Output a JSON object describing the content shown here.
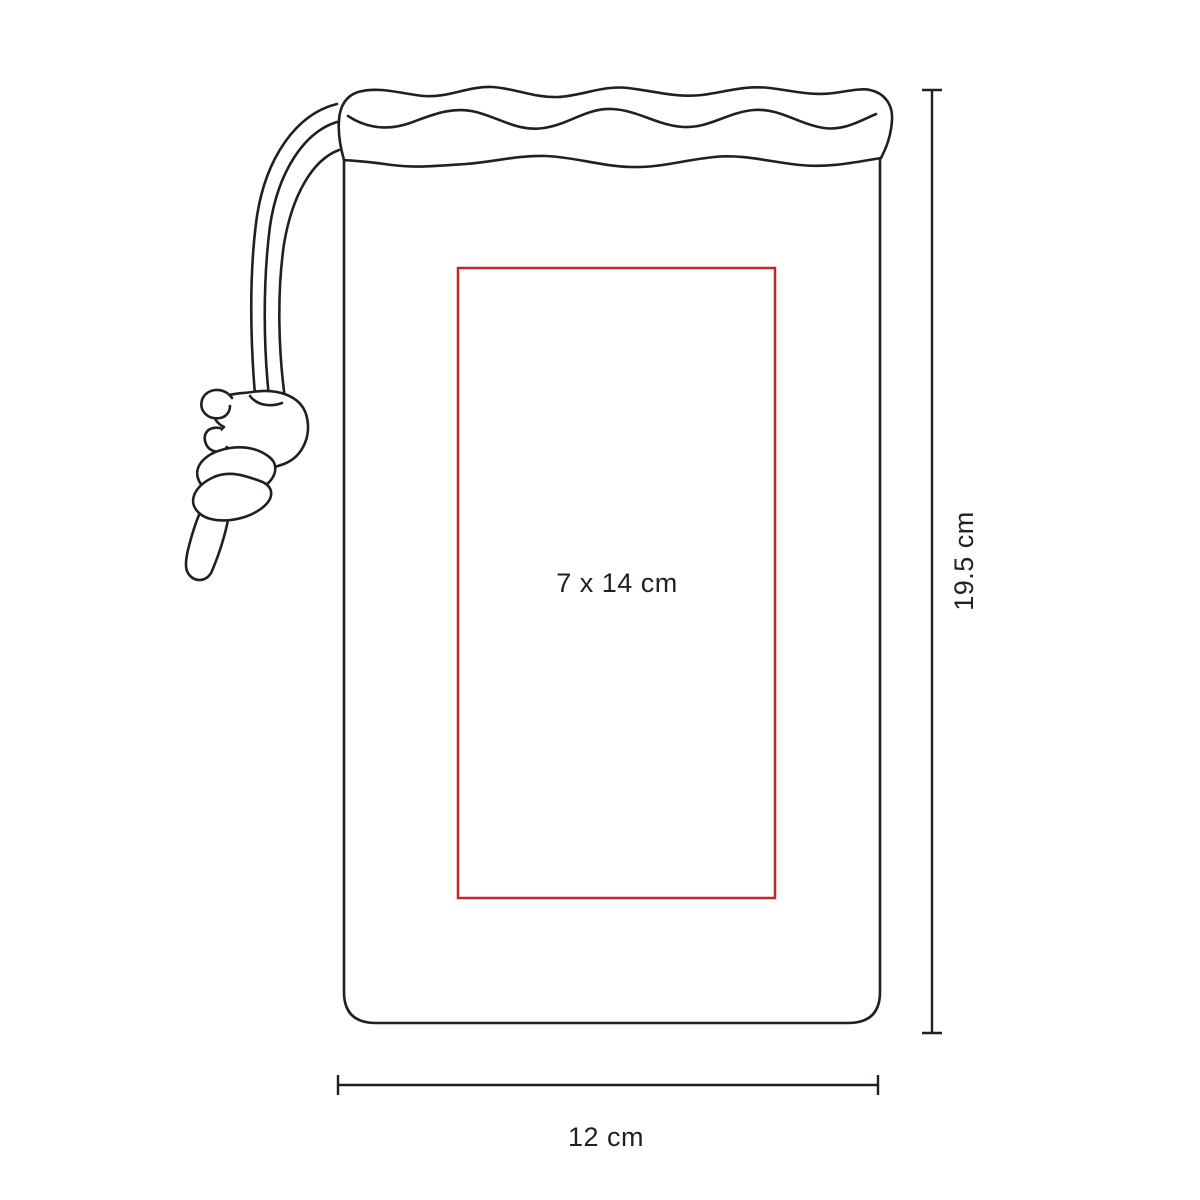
{
  "diagram": {
    "colors": {
      "background": "#ffffff",
      "outline": "#231f20",
      "print_area_border": "#c1272d"
    },
    "print_area": {
      "label": "7 x 14 cm",
      "width_cm": 7,
      "height_cm": 14
    },
    "height_dimension": {
      "label": "19.5 cm",
      "value_cm": 19.5
    },
    "width_dimension": {
      "label": "12 cm",
      "value_cm": 12
    }
  }
}
